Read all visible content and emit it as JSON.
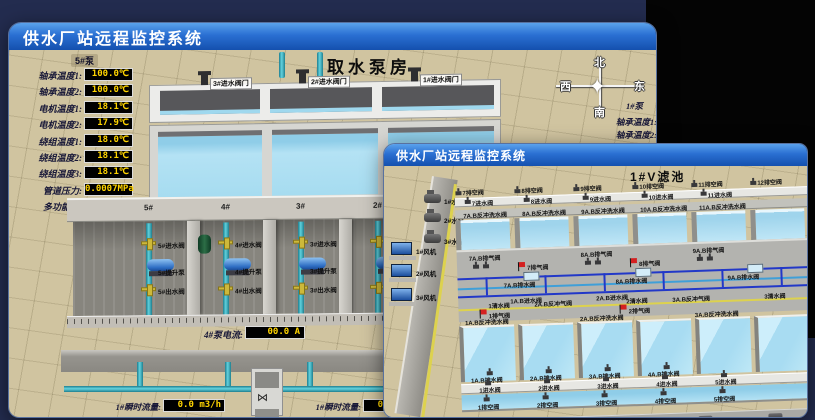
{
  "back_window": {
    "title": "供水厂站远程监控系统",
    "scene_title": "取水泵房",
    "pump_panel": {
      "header": "5#泵",
      "rows": [
        {
          "label": "轴承温度1:",
          "value": "100.0℃"
        },
        {
          "label": "轴承温度2:",
          "value": "100.0℃"
        },
        {
          "label": "电机温度1:",
          "value": "18.1℃"
        },
        {
          "label": "电机温度2:",
          "value": "17.9℃"
        },
        {
          "label": "绕组温度1:",
          "value": "18.0℃"
        },
        {
          "label": "绕组温度2:",
          "value": "18.1℃"
        },
        {
          "label": "绕组温度3:",
          "value": "18.1℃"
        },
        {
          "label": "管道压力:",
          "value": "0.0007MPa"
        },
        {
          "label": "多功能阀:",
          "value": "0%"
        }
      ]
    },
    "intake_valves": [
      "3#进水阀门",
      "2#进水阀门",
      "1#进水阀门"
    ],
    "compass": {
      "north": "北",
      "south": "南",
      "west": "西",
      "east": "东"
    },
    "right_panel": {
      "header": "1#泵",
      "rows": [
        "轴承温度1:",
        "轴承温度2:"
      ]
    },
    "pump_bays": [
      {
        "bay": "5#",
        "inlet": "5#进水阀",
        "pump": "5#提升泵",
        "outlet": "5#出水阀"
      },
      {
        "bay": "4#",
        "inlet": "4#进水阀",
        "pump": "4#提升泵",
        "outlet": "4#出水阀"
      },
      {
        "bay": "3#",
        "inlet": "3#进水阀",
        "pump": "3#提升泵",
        "outlet": "3#出水阀"
      },
      {
        "bay": "2#",
        "inlet": "2#进水阀",
        "pump": "2#提升泵",
        "outlet": "2#出水阀"
      }
    ],
    "current_meters": [
      {
        "label": "4#泵电流:",
        "value": "00.0 A"
      },
      {
        "label": "2#泵电流:",
        "value": ""
      }
    ],
    "flow_meters": [
      {
        "label": "1#瞬时流量:",
        "value": "0.0 m3/h"
      },
      {
        "label": "1#瞬时流量:",
        "value": "0.0 m3/h"
      }
    ]
  },
  "front_window": {
    "title": "供水厂站远程监控系统",
    "scene_title": "1#V滤池",
    "left_equipment": {
      "pumps": [
        "1#水泵",
        "2#水泵",
        "3#水泵"
      ],
      "fans": [
        "1#风机",
        "2#风机",
        "3#风机"
      ]
    },
    "top_cells": {
      "drain_valves": [
        "7排空阀",
        "8排空阀",
        "9排空阀",
        "10排空阀",
        "11排空阀",
        "12排空阀"
      ],
      "inlet_valves": [
        "7进水阀",
        "8进水阀",
        "9进水阀",
        "10进水阀",
        "11进水阀"
      ],
      "backwash_valves": [
        "7A.B反冲洗水阀",
        "8A.B反冲洗水阀",
        "9A.B反冲洗水阀",
        "10A.B反冲洗水阀",
        "11A.B反冲洗水阀"
      ]
    },
    "gallery": {
      "exhaust_valves": [
        "7A.B排气阀",
        "8A.B排气阀",
        "9A.B排气阀"
      ],
      "air_flags": [
        "7排气阀",
        "8排气阀"
      ],
      "drain_valves": [
        "7A.B排水阀",
        "8A.B排水阀",
        "9A.B排水阀"
      ],
      "inlet_valves": [
        "1A.B进水阀",
        "2A.B进水阀"
      ],
      "clean_row": [
        "1清水阀",
        "2A.B反冲气阀",
        "2清水阀",
        "3A.B反冲气阀",
        "3清水阀"
      ],
      "air_flags2": [
        "1排气阀",
        "2排气阀"
      ],
      "backwash_water": [
        "1A.B反冲洗水阀",
        "2A.B反冲洗水阀",
        "3A.B反冲洗水阀"
      ]
    },
    "bottom_cells": {
      "drain_labels": [
        "1A.B排水阀",
        "2A.B排水阀",
        "3A.B排水阀",
        "4A.B排水阀"
      ],
      "inlet_valves": [
        "1进水阀",
        "2进水阀",
        "3进水阀",
        "4进水阀",
        "5进水阀"
      ],
      "empty_valves": [
        "1排空阀",
        "2排空阀",
        "3排空阀",
        "4排空阀",
        "5排空阀"
      ]
    }
  },
  "colors": {
    "titlebar_blue": "#1a5cc0",
    "lcd_text": "#ffd400",
    "water": "#a9ddf1",
    "scene_tan": "#d0c4a0",
    "alarm_red": "#d42020"
  }
}
